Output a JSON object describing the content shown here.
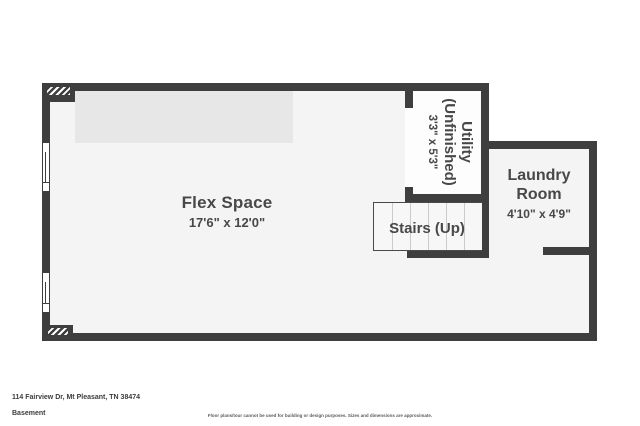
{
  "title": "Basement floor plan",
  "colors": {
    "wall": "#3e3e3e",
    "floor": "#f4f4f4",
    "utility_floor": "#fdfdfd",
    "upper_band": "#e7e7e7",
    "tread_line": "#cbcbcb",
    "label_text": "#484848"
  },
  "rooms": {
    "flex": {
      "name": "Flex Space",
      "dims": "17'6\" x 12'0\""
    },
    "utility": {
      "lines": [
        "Utility",
        "(Unfinished)"
      ],
      "dims": "3'3\" x 5'3\""
    },
    "stairs": {
      "name": "Stairs (Up)"
    },
    "laundry": {
      "lines": [
        "Laundry",
        "Room"
      ],
      "dims": "4'10\" x 4'9\""
    }
  },
  "footer": {
    "address": "114 Fairview Dr, Mt Pleasant, TN 38474",
    "level": "Basement",
    "disclaimer": "Floor plans/tour cannot be used for building or design purposes. Sizes and dimensions are approximate."
  }
}
